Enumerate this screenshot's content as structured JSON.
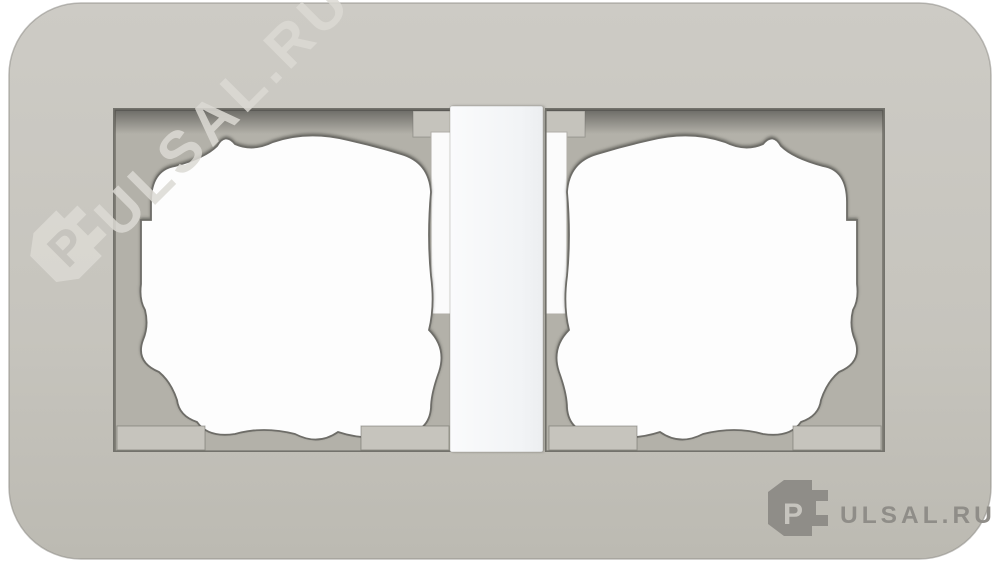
{
  "product": {
    "description": "double-socket-cover-frame",
    "watermark": {
      "p": "P",
      "rest": "ULSAL.RU",
      "full": "PULSAL.RU"
    },
    "logo": {
      "p": "P",
      "rest": "ULSAL.RU",
      "full": "PULSAL.RU"
    }
  },
  "icons": {
    "brand_icon": "plug-icon"
  },
  "colors": {
    "background": "#ffffff",
    "frame": "#c6c4bd",
    "frame_light": "#cdcbc5",
    "frame_dark": "#bdbbb3",
    "recess": "#b3b1a9",
    "recess_shadow": "#5a5955",
    "insert_white": "#fdfdfd",
    "strip_light": "#fafbfc",
    "strip_dark": "#eceef0",
    "logo_grey": "#8f8d88",
    "logo_p": "#c6c4be",
    "watermark": "#dcdad4"
  }
}
